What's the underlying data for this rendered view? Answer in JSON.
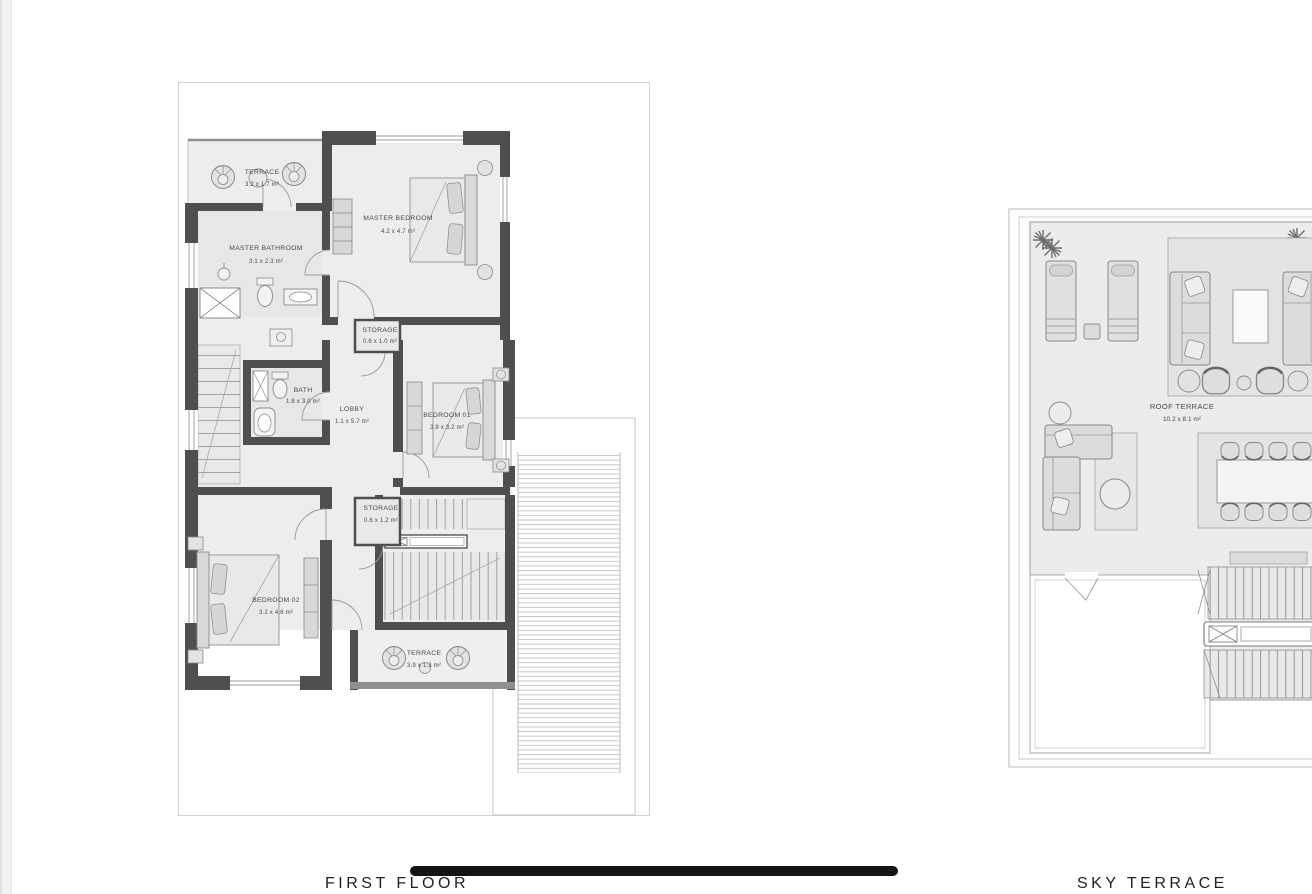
{
  "footer": {
    "first_floor": "FIRST FLOOR",
    "sky_terrace": "SKY TERRACE"
  },
  "first_floor": {
    "rooms": {
      "terrace_top": {
        "name": "TERRACE",
        "dims": "3.2 x 1.7 m²"
      },
      "master_bedroom": {
        "name": "MASTER BEDROOM",
        "dims": "4.2 x 4.7 m²"
      },
      "master_bathroom": {
        "name": "MASTER BATHROOM",
        "dims": "3.1 x 2.3 m²"
      },
      "storage_upper": {
        "name": "STORAGE",
        "dims": "0.6 x 1.0 m²"
      },
      "bath": {
        "name": "BATH",
        "dims": "1.8 x 3.0 m²"
      },
      "lobby": {
        "name": "LOBBY",
        "dims": "1.1 x 5.7 m²"
      },
      "bedroom_01": {
        "name": "BEDROOM 01",
        "dims": "3.9 x 3.2 m²"
      },
      "storage_lower": {
        "name": "STORAGE",
        "dims": "0.6 x 1.2 m²"
      },
      "bedroom_02": {
        "name": "BEDROOM 02",
        "dims": "3.2 x 4.6 m²"
      },
      "terrace_bottom": {
        "name": "TERRACE",
        "dims": "3.9 x 1.3 m²"
      }
    }
  },
  "sky_terrace": {
    "rooms": {
      "roof_terrace": {
        "name": "ROOF TERRACE",
        "dims": "10.2 x 8.1 m²"
      }
    }
  },
  "colors": {
    "wall": "#4f4f4f",
    "floor": "#ededed",
    "floor_dark": "#e7e7e7",
    "furniture": "#dcdcdc",
    "furniture_line": "#8a8a8a",
    "boundary_line": "#cccccc",
    "footer_bar": "#141414",
    "label_text": "#4a4a4a"
  }
}
